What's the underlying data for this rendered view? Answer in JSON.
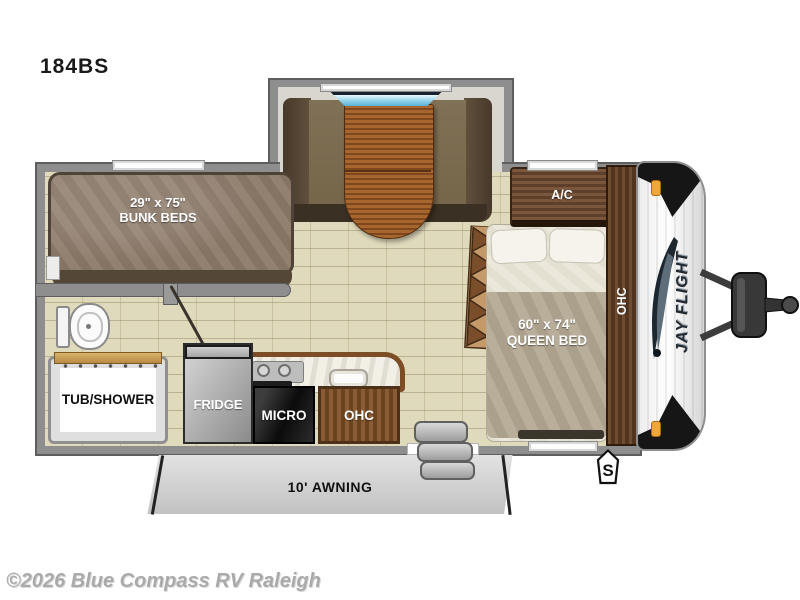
{
  "page": {
    "model": "184BS",
    "watermark": "©2026 Blue Compass RV Raleigh"
  },
  "floorplan": {
    "bunk": {
      "line1": "29\" x 75\"",
      "line2": "BUNK BEDS"
    },
    "bathroom": {
      "tub_label": "TUB/SHOWER"
    },
    "kitchen": {
      "fridge": "FRIDGE",
      "micro": "MICRO",
      "ohc": "OHC"
    },
    "bedroom": {
      "ac": "A/C",
      "line1": "60\" x 74\"",
      "line2": "QUEEN BED",
      "ohc": "OHC"
    },
    "exterior": {
      "awning": "10' AWNING",
      "spare_marker": "S",
      "brand": "JAY FLIGHT"
    }
  },
  "colors": {
    "wall": "#8e8e8e",
    "floor": "#e0dabc",
    "wood": "#6b4a33",
    "window_blue": "#7ec6e2",
    "marker_amber": "#f0a73a",
    "awning": "#d4d4d4"
  }
}
